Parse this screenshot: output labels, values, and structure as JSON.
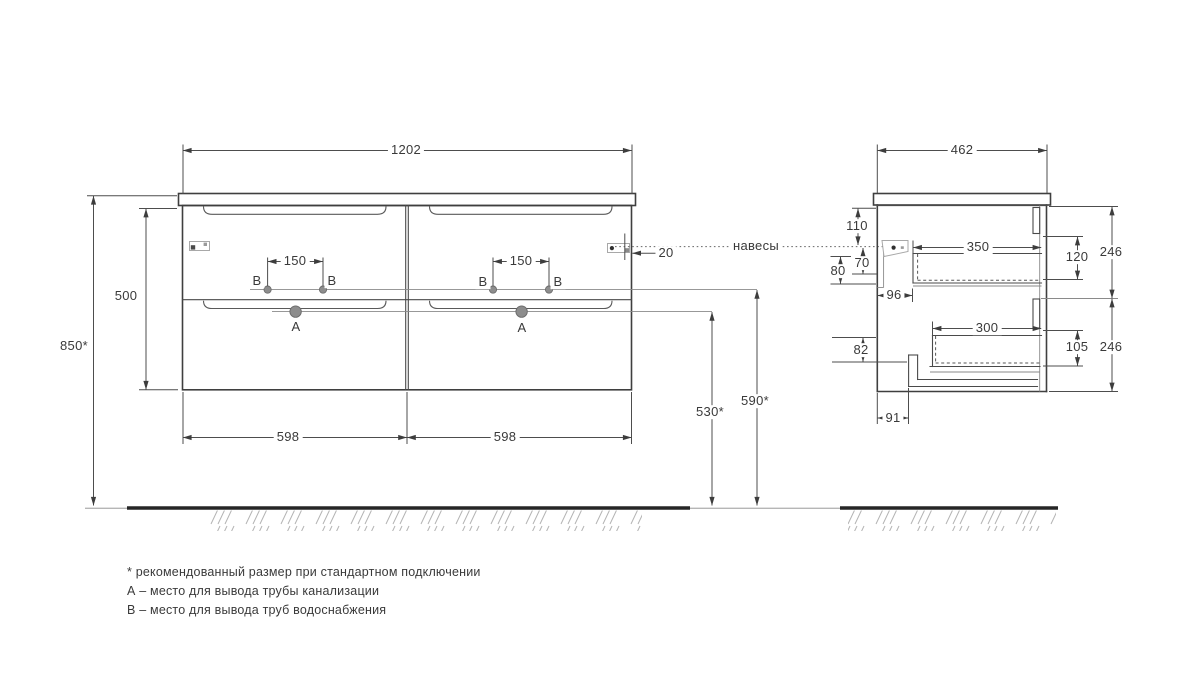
{
  "front_view": {
    "overall_width": "1202",
    "cabinet_height": "500",
    "install_height": "850*",
    "drawer_widths": [
      "598",
      "598"
    ],
    "water_hole_spacing": [
      "150",
      "150"
    ],
    "hanger_edge_offset": "20",
    "drain_outlet_height": "530*",
    "water_outlet_height": "590*",
    "drain_label": "А",
    "water_label": "В"
  },
  "side_view": {
    "overall_depth": "462",
    "top_to_hanger": "110",
    "hanger_drop": "70",
    "front_rail_height": "80",
    "front_to_drawer": "96",
    "upper_drawer_depth": "350",
    "upper_drawer_inner_height": "120",
    "upper_section_height": "246",
    "lower_drawer_depth": "300",
    "lower_drawer_inner_height": "105",
    "lower_section_height": "246",
    "bottom_recess_height": "82",
    "bottom_recess_depth": "91"
  },
  "annotations": {
    "hangers_label": "навесы",
    "footnotes": [
      "* рекомендованный размер при стандартном подключении",
      "А – место для вывода трубы канализации",
      "В – место для вывода труб водоснабжения"
    ]
  },
  "colors": {
    "line": "#3f3f3f",
    "dimension": "#4d4d4d",
    "hole_fill": "#8d8d8d",
    "ground": "#262626",
    "hatch": "#b4b4b4",
    "background": "#ffffff"
  }
}
